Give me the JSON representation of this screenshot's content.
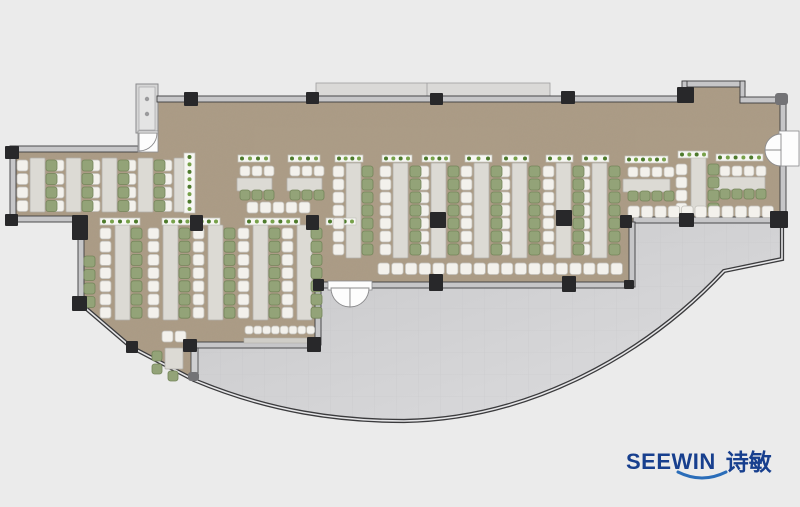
{
  "logo": {
    "text_en": "SEEWIN",
    "text_zh": "诗敏",
    "navy": "#173f8e",
    "swoosh_color": "#2a6db9"
  },
  "plan": {
    "colors": {
      "bg": "#ebebeb",
      "floor": "#ab9b85",
      "grain_rgb": "0.42 0.35 0.26",
      "wall": "#c6c6c8",
      "wall_edge": "#3b3b3d",
      "column": "#28282a",
      "gray_node": "#737376",
      "table": "#dcdad4",
      "table_edge": "#b2b0aa",
      "chair_white": "#f3f1ec",
      "chair_white_edge": "#c2c0ba",
      "chair_green": "#93a378",
      "chair_green_edge": "#74855a",
      "planter_box": "#f7f7f3",
      "planter_edge": "#c3c3bb",
      "plant_dark": "#4d7a2c",
      "plant_light": "#77a14a",
      "terrace_dark": "#c7c7c9",
      "terrace_light": "#dddddf",
      "terrace_grid": "#bdbdbf",
      "canopy": "#dad9d7",
      "canopy_edge": "#9d9d9f",
      "shaft": "#d6d6d6",
      "shaft_inner": "#e4e4e4",
      "door_fill": "#fdfdfd",
      "door_edge": "#8a8a8c",
      "counter": "#cfcdc7"
    },
    "floor_path": "M157,97 L686,97 L686,86 L745,86 L745,103 L786,103 L786,222 L633,222 L633,287 L318,287 L318,347 L196,347 L196,381 L133,349 L82,307 L82,222 L13,222 L13,151 L157,151 Z",
    "terrace_path": "M196,347 L318,347 L318,287 L633,287 L633,222 L782,222 L782,259 L724,271 C645,355 530,419 404,421 C340,421 270,412 194,380 Z",
    "facade_path": "M82,305 L131,347 L194,380 C270,412 340,421 404,421 C530,419 645,355 724,271 L782,259 L782,224",
    "canopy": [
      316,
      83,
      234,
      13
    ],
    "canopy_seam_x": 427,
    "shaft": {
      "outer": [
        136,
        84,
        22,
        49
      ],
      "inner": [
        139,
        87,
        16,
        43
      ],
      "knobs": [
        [
          147,
          99
        ],
        [
          147,
          114
        ]
      ]
    },
    "walls": [
      [
        157,
        96,
        529,
        6
      ],
      [
        684,
        81,
        61,
        6
      ],
      [
        682,
        81,
        5,
        21
      ],
      [
        740,
        81,
        5,
        22
      ],
      [
        740,
        97,
        46,
        6
      ],
      [
        780,
        101,
        6,
        34
      ],
      [
        780,
        163,
        6,
        55
      ],
      [
        633,
        217,
        153,
        6
      ],
      [
        629,
        222,
        6,
        65
      ],
      [
        318,
        282,
        315,
        6
      ],
      [
        315,
        287,
        6,
        58
      ],
      [
        193,
        342,
        125,
        6
      ],
      [
        10,
        146,
        128,
        6
      ],
      [
        10,
        146,
        6,
        77
      ],
      [
        10,
        216,
        66,
        6
      ],
      [
        78,
        238,
        6,
        62
      ]
    ],
    "stub": [
      191,
      348,
      7,
      32
    ],
    "columns": [
      [
        184,
        92,
        14,
        14
      ],
      [
        306,
        92,
        13,
        12
      ],
      [
        430,
        93,
        13,
        12
      ],
      [
        561,
        91,
        14,
        13
      ],
      [
        677,
        87,
        17,
        16
      ],
      [
        190,
        215,
        13,
        16
      ],
      [
        306,
        215,
        13,
        15
      ],
      [
        430,
        212,
        16,
        16
      ],
      [
        556,
        210,
        16,
        16
      ],
      [
        620,
        215,
        12,
        13
      ],
      [
        679,
        213,
        15,
        14
      ],
      [
        770,
        211,
        18,
        17
      ],
      [
        313,
        279,
        11,
        12
      ],
      [
        429,
        274,
        14,
        17
      ],
      [
        562,
        276,
        14,
        16
      ],
      [
        624,
        280,
        10,
        9
      ],
      [
        183,
        339,
        14,
        13
      ],
      [
        307,
        337,
        14,
        15
      ],
      [
        5,
        146,
        14,
        13
      ],
      [
        5,
        214,
        13,
        12
      ],
      [
        72,
        215,
        16,
        25
      ],
      [
        72,
        296,
        15,
        15
      ],
      [
        126,
        341,
        12,
        12
      ]
    ],
    "gray_nodes": [
      [
        775,
        93,
        13,
        12
      ],
      [
        188,
        372,
        11,
        9
      ]
    ],
    "tables": [
      [
        30,
        158,
        15,
        54
      ],
      [
        66,
        158,
        15,
        54
      ],
      [
        102,
        158,
        15,
        54
      ],
      [
        138,
        158,
        15,
        54
      ],
      [
        174,
        158,
        15,
        54
      ],
      [
        237,
        178,
        35,
        13
      ],
      [
        287,
        178,
        35,
        13
      ],
      [
        115,
        225,
        15,
        95
      ],
      [
        163,
        225,
        15,
        95
      ],
      [
        208,
        225,
        15,
        95
      ],
      [
        253,
        225,
        15,
        95
      ],
      [
        297,
        225,
        15,
        95
      ],
      [
        346,
        163,
        15,
        95
      ],
      [
        393,
        163,
        15,
        95
      ],
      [
        431,
        163,
        15,
        95
      ],
      [
        474,
        163,
        15,
        95
      ],
      [
        512,
        163,
        15,
        95
      ],
      [
        556,
        163,
        15,
        95
      ],
      [
        592,
        163,
        15,
        95
      ],
      [
        623,
        179,
        47,
        13
      ],
      [
        691,
        157,
        15,
        58
      ],
      [
        714,
        177,
        51,
        13
      ],
      [
        165,
        348,
        18,
        21
      ]
    ],
    "planters": [
      [
        184,
        153,
        11,
        60
      ],
      [
        238,
        155,
        32,
        7
      ],
      [
        288,
        155,
        32,
        7
      ],
      [
        100,
        218,
        40,
        7
      ],
      [
        162,
        218,
        58,
        7
      ],
      [
        245,
        218,
        55,
        7
      ],
      [
        326,
        218,
        30,
        7
      ],
      [
        335,
        155,
        28,
        7
      ],
      [
        382,
        155,
        30,
        7
      ],
      [
        422,
        155,
        28,
        7
      ],
      [
        465,
        155,
        27,
        7
      ],
      [
        502,
        155,
        27,
        7
      ],
      [
        546,
        155,
        27,
        7
      ],
      [
        582,
        155,
        27,
        7
      ],
      [
        625,
        156,
        43,
        7
      ],
      [
        678,
        151,
        30,
        7
      ],
      [
        716,
        154,
        47,
        7
      ]
    ],
    "chair_groups": [
      [
        "w",
        "col",
        17,
        160,
        4,
        13.5,
        11
      ],
      [
        "w",
        "col",
        53,
        160,
        4,
        13.5,
        11
      ],
      [
        "w",
        "col",
        89,
        160,
        4,
        13.5,
        11
      ],
      [
        "w",
        "col",
        125,
        160,
        4,
        13.5,
        11
      ],
      [
        "w",
        "col",
        161,
        160,
        4,
        13.5,
        11
      ],
      [
        "g",
        "col",
        46,
        160,
        4,
        13.5,
        11
      ],
      [
        "g",
        "col",
        82,
        160,
        4,
        13.5,
        11
      ],
      [
        "g",
        "col",
        118,
        160,
        4,
        13.5,
        11
      ],
      [
        "g",
        "col",
        154,
        160,
        4,
        13.5,
        11
      ],
      [
        "g",
        "col",
        84,
        256,
        4,
        13.5,
        11
      ],
      [
        "w",
        "col",
        100,
        228,
        7,
        13.2,
        11
      ],
      [
        "w",
        "col",
        148,
        228,
        7,
        13.2,
        11
      ],
      [
        "w",
        "col",
        193,
        228,
        7,
        13.2,
        11
      ],
      [
        "w",
        "col",
        238,
        228,
        7,
        13.2,
        11
      ],
      [
        "w",
        "col",
        282,
        228,
        7,
        13.2,
        11
      ],
      [
        "g",
        "col",
        131,
        228,
        7,
        13.2,
        11
      ],
      [
        "g",
        "col",
        179,
        228,
        7,
        13.2,
        11
      ],
      [
        "g",
        "col",
        224,
        228,
        7,
        13.2,
        11
      ],
      [
        "g",
        "col",
        269,
        228,
        7,
        13.2,
        11
      ],
      [
        "g",
        "col",
        311,
        228,
        7,
        13.2,
        11
      ],
      [
        "w",
        "col",
        333,
        166,
        7,
        13,
        11
      ],
      [
        "w",
        "col",
        380,
        166,
        7,
        13,
        11
      ],
      [
        "w",
        "col",
        418,
        166,
        7,
        13,
        11
      ],
      [
        "w",
        "col",
        461,
        166,
        7,
        13,
        11
      ],
      [
        "w",
        "col",
        499,
        166,
        7,
        13,
        11
      ],
      [
        "w",
        "col",
        543,
        166,
        7,
        13,
        11
      ],
      [
        "w",
        "col",
        579,
        166,
        7,
        13,
        11
      ],
      [
        "g",
        "col",
        362,
        166,
        7,
        13,
        11
      ],
      [
        "g",
        "col",
        410,
        166,
        7,
        13,
        11
      ],
      [
        "g",
        "col",
        448,
        166,
        7,
        13,
        11
      ],
      [
        "g",
        "col",
        491,
        166,
        7,
        13,
        11
      ],
      [
        "g",
        "col",
        529,
        166,
        7,
        13,
        11
      ],
      [
        "g",
        "col",
        573,
        166,
        7,
        13,
        11
      ],
      [
        "g",
        "col",
        609,
        166,
        7,
        13,
        11
      ],
      [
        "w",
        "col",
        676,
        164,
        4,
        13,
        11
      ],
      [
        "g",
        "col",
        708,
        164,
        4,
        13,
        11
      ],
      [
        "w",
        "row",
        240,
        166,
        3,
        12,
        10
      ],
      [
        "w",
        "row",
        290,
        166,
        3,
        12,
        10
      ],
      [
        "g",
        "row",
        240,
        190,
        3,
        12,
        10
      ],
      [
        "g",
        "row",
        290,
        190,
        3,
        12,
        10
      ],
      [
        "w",
        "row",
        247,
        202,
        5,
        13,
        11
      ],
      [
        "w",
        "row",
        628,
        167,
        4,
        12,
        10
      ],
      [
        "g",
        "row",
        628,
        191,
        4,
        12,
        10
      ],
      [
        "w",
        "row",
        720,
        166,
        4,
        12,
        10
      ],
      [
        "g",
        "row",
        720,
        189,
        4,
        12,
        10
      ],
      [
        "w",
        "row",
        378,
        263,
        18,
        13.7,
        11.5
      ],
      [
        "w",
        "row",
        628,
        206,
        11,
        13.4,
        11.5
      ],
      [
        "w",
        "row",
        245,
        326,
        8,
        8.8,
        8
      ]
    ],
    "single_chairs": [
      [
        "w",
        162,
        331,
        11
      ],
      [
        "w",
        175,
        331,
        11
      ],
      [
        "g",
        152,
        351,
        10
      ],
      [
        "g",
        152,
        364,
        10
      ],
      [
        "g",
        168,
        371,
        10
      ]
    ],
    "counter": [
      244,
      338,
      70,
      5
    ],
    "doors": [
      {
        "rect": [
          779,
          131,
          20,
          35
        ],
        "leaves": [
          "M781,134 A16,16 0 0 0 765,150 L781,150 Z",
          "M781,166 A16,16 0 0 1 765,150 L781,150 Z"
        ]
      },
      {
        "rect": [
          328,
          281,
          44,
          9
        ],
        "leaves": [
          "M331,288 A19,19 0 0 0 350,307 L350,288 Z",
          "M369,288 A19,19 0 0 1 350,307 L350,288 Z"
        ]
      },
      {
        "rect": [
          138,
          131,
          20,
          21
        ],
        "leaves": [
          "M157,133 A18,18 0 0 1 139,151 L139,133 Z"
        ]
      }
    ]
  }
}
